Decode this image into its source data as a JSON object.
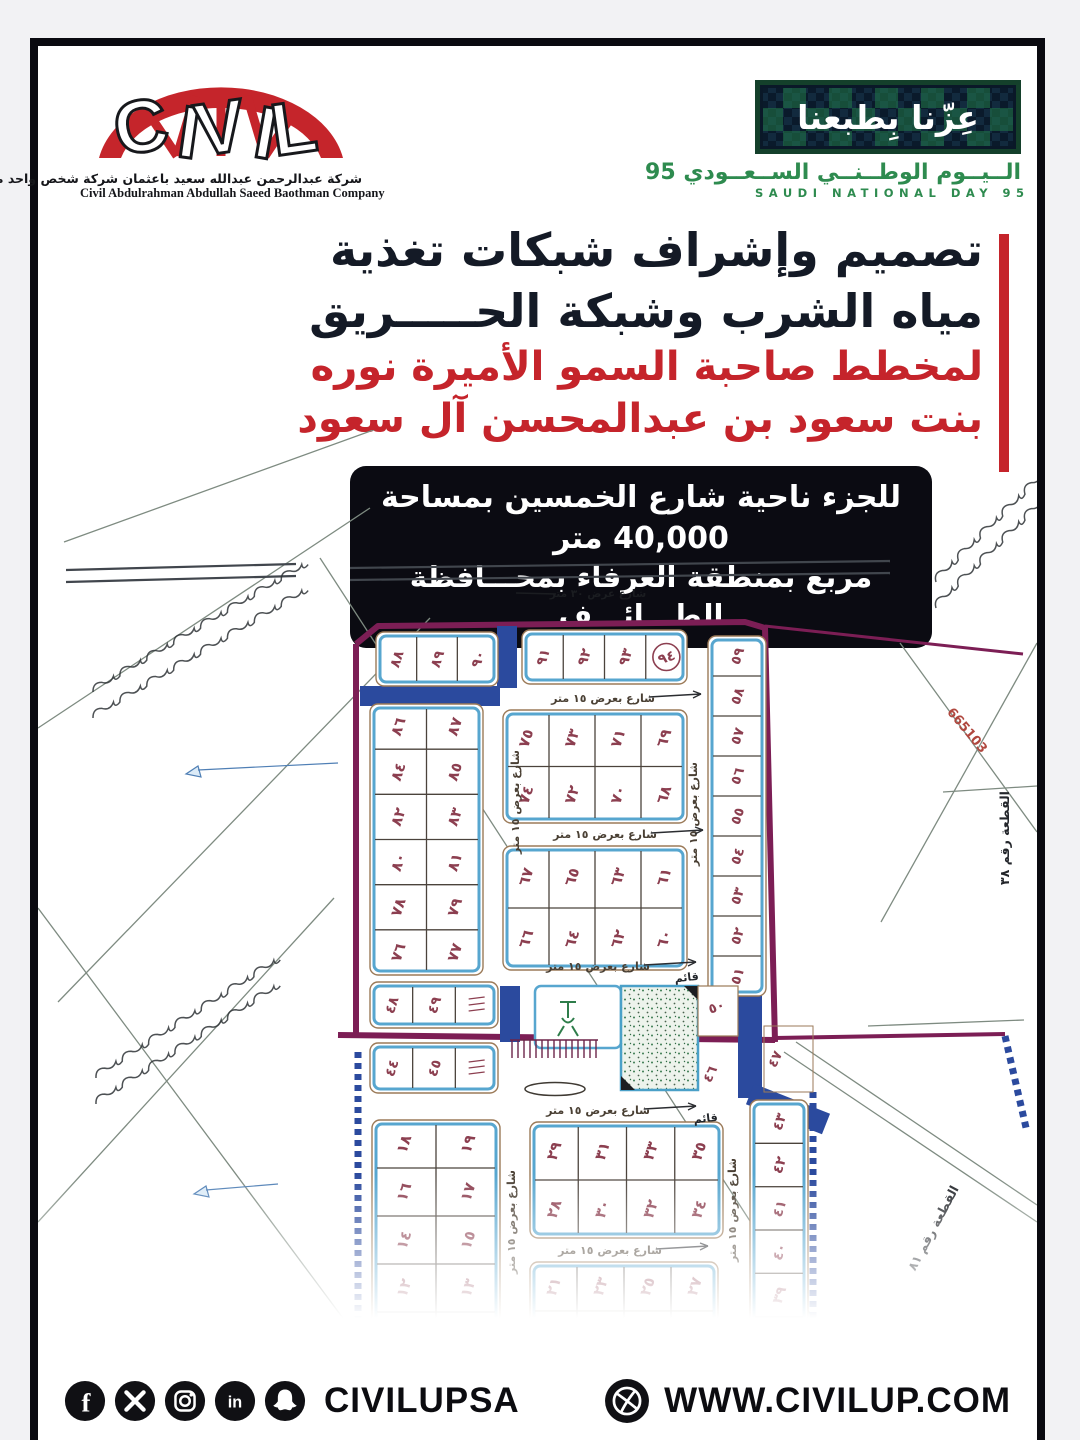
{
  "brand": {
    "logo_word": "CIVIL",
    "company_ar": "شركة عبدالرحمن عبدالله سعيد باعثمان شركة شخص واحد مهنية",
    "company_en": "Civil Abdulrahman Abdullah Saeed Baothman Company"
  },
  "national_day": {
    "slogan_ar": "عِزّنا بِطبعنا",
    "title_ar": "الــيــوم الوطــنــي الســعــودي 95",
    "title_en": "SAUDI NATIONAL DAY 95"
  },
  "headline": {
    "line1": "تصميم وإشراف شبكات تغذية",
    "line2": "مياه الشرب وشبكة الحـــــريق",
    "line3": "لمخطط صاحبة السمو الأميرة نوره",
    "line4": "بنت سعود بن عبدالمحسن آل سعود"
  },
  "details_badge": {
    "line1": "للجزء ناحية شارع الخمسين بمساحة 40,000 متر",
    "line2": "مربع بمنطقة العرفاء بمحـــافظة الطـــائـــف"
  },
  "map": {
    "survey_label": "665103",
    "street_label_15": "شارع بعرض ١٥ متر",
    "street_label_30": "شارع عرض ٣٠ متر",
    "existing_label": "قائم",
    "parcel_label_right": "القطعة رقم ٣٨",
    "parcel_label_bottom": "القطعة رقم ٨١",
    "circled_plot": "٩٤",
    "blocks": {
      "top_left_row": [
        [
          "٨٨",
          "٨٩",
          "٩٠"
        ]
      ],
      "top_mid_row": [
        [
          "٩١",
          "٩٢",
          "٩٣",
          "٩٤"
        ]
      ],
      "west_block": [
        [
          "٨٦",
          "٨٧"
        ],
        [
          "٨٤",
          "٨٥"
        ],
        [
          "٨٢",
          "٨٣"
        ],
        [
          "٨٠",
          "٨١"
        ],
        [
          "٧٨",
          "٧٩"
        ],
        [
          "٧٦",
          "٧٧"
        ]
      ],
      "center_north_a": [
        [
          "٧٥",
          "٧٣",
          "٧١",
          "٦٩"
        ],
        [
          "٧٤",
          "٧٢",
          "٧٠",
          "٦٨"
        ]
      ],
      "center_north_b": [
        [
          "٦٧",
          "٦٥",
          "٦٣",
          "٦١"
        ],
        [
          "٦٦",
          "٦٤",
          "٦٢",
          "٦٠"
        ]
      ],
      "east_column": [
        [
          "٥٩"
        ],
        [
          "٥٨"
        ],
        [
          "٥٧"
        ],
        [
          "٥٦"
        ],
        [
          "٥٥"
        ],
        [
          "٥٤"
        ],
        [
          "٥٣"
        ],
        [
          "٥٢"
        ],
        [
          "٥١"
        ]
      ],
      "mid_west_a": [
        [
          "٤٨",
          "٤٩",
          null
        ]
      ],
      "mid_west_b": [
        [
          "٤٤",
          "٤٥",
          null
        ]
      ],
      "south_west": [
        [
          "١٨",
          "١٩"
        ],
        [
          "١٦",
          "١٧"
        ],
        [
          "١٤",
          "١٥"
        ],
        [
          "١٢",
          "١٣"
        ],
        [
          "١٠",
          "١١"
        ]
      ],
      "south_mid_a": [
        [
          "٢٩",
          "٣١",
          "٣٣",
          "٣٥"
        ],
        [
          "٢٨",
          "٣٠",
          "٣٢",
          "٣٤"
        ]
      ],
      "south_mid_b": [
        [
          "٢١",
          "٢٣",
          "٢٥",
          "٢٧"
        ],
        [
          "٢٠",
          "٢٢",
          "٢٤",
          "٢٦"
        ]
      ],
      "south_east_column": [
        [
          "٤٣"
        ],
        [
          "٤٢"
        ],
        [
          "٤١"
        ],
        [
          "٤٠"
        ],
        [
          "٣٩"
        ],
        [
          "٣٨"
        ]
      ],
      "loose": [
        "٥٠",
        "٤٦",
        "٤٧"
      ]
    }
  },
  "footer": {
    "handle": "CIVILUPSA",
    "website": "WWW.CIVILUP.COM",
    "social_icons": [
      "facebook-icon",
      "x-icon",
      "instagram-icon",
      "linkedin-icon",
      "snapchat-icon"
    ],
    "website_icon": "globe-icon"
  },
  "colors": {
    "accent_red": "#c5242b",
    "dark_navy": "#141a26",
    "badge_black": "#0b0b12",
    "nd_green": "#2e8b4f",
    "map_boundary_purple": "#7c1e55",
    "map_street_blue": "#2b4a9e",
    "plot_number_maroon": "#8c3f50"
  }
}
